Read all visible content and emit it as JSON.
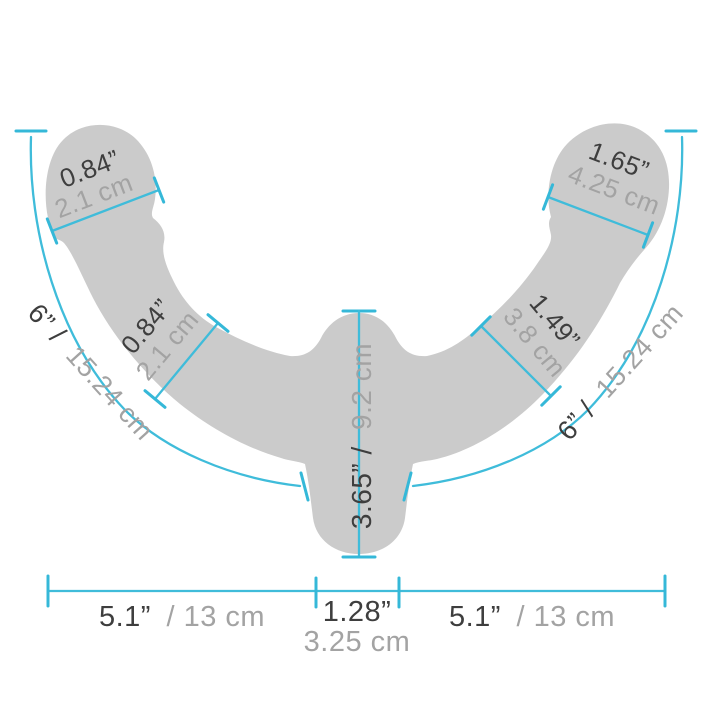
{
  "diagram": {
    "type": "product-dimension-diagram",
    "colors": {
      "accent": "#3fbcda",
      "shape": "#cbcbcb",
      "text_dark": "#3e3e3e",
      "text_muted": "#a3a3a3"
    },
    "measurements": {
      "head_left": {
        "inches": "0.84”",
        "cm": "2.1 cm"
      },
      "head_right": {
        "inches": "1.65”",
        "cm": "4.25 cm"
      },
      "shaft_left": {
        "inches": "0.84”",
        "cm": "2.1 cm"
      },
      "shaft_right": {
        "inches": "1.49”",
        "cm": "3.8 cm"
      },
      "arc_left": {
        "inches": "6” /",
        "cm": "15.24 cm"
      },
      "arc_right": {
        "inches": "6” /",
        "cm": "15.24 cm"
      },
      "center": {
        "inches": "3.65” /",
        "cm": "9.2 cm"
      },
      "bottom_left": {
        "inches": "5.1”",
        "cm": "/ 13 cm"
      },
      "bottom_center": {
        "inches": "1.28”",
        "cm": "3.25 cm"
      },
      "bottom_right": {
        "inches": "5.1”",
        "cm": "/ 13 cm"
      }
    }
  }
}
